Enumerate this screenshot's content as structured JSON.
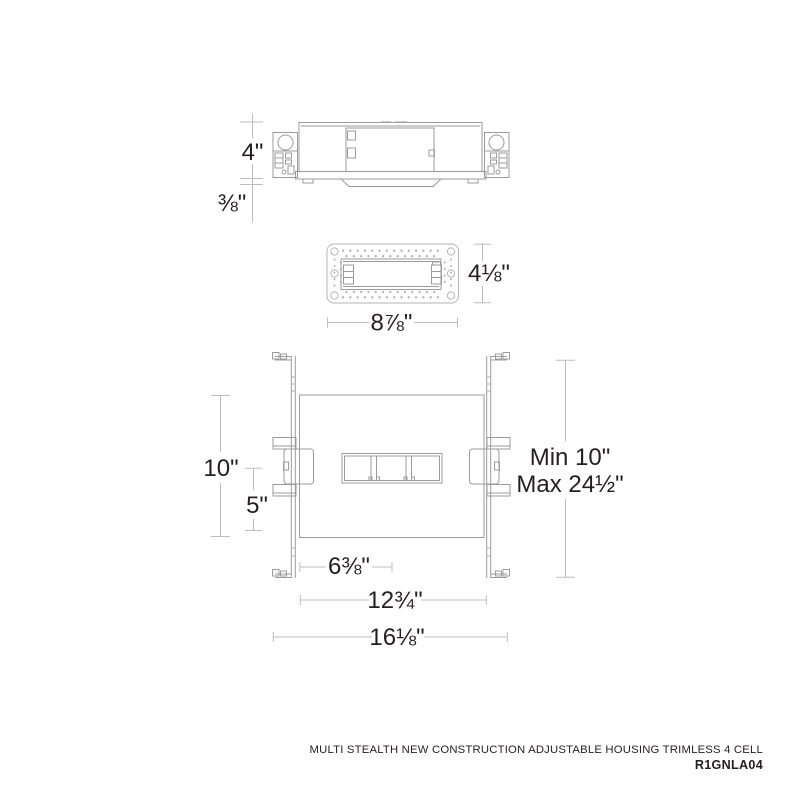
{
  "product": {
    "title": "MULTI STEALTH NEW CONSTRUCTION ADJUSTABLE HOUSING TRIMLESS 4 CELL",
    "model": "R1GNLA04"
  },
  "dimensions": {
    "side_height": "4\"",
    "trim_lip_depth": "⅜\"",
    "plate_height": "4⅛\"",
    "plate_width": "8⅞\"",
    "housing_depth": "10\"",
    "center_to_edge": "5\"",
    "hanger_min": "Min 10\"",
    "hanger_max": "Max 24½\"",
    "edge_to_center": "6⅜\"",
    "housing_width": "12¾\"",
    "overall_width": "16⅛\""
  },
  "colors": {
    "drawing_line": "#9b9b9b",
    "light_line": "#b5b5b5",
    "dimension_line": "#bdbdbd",
    "text": "#231f20"
  }
}
